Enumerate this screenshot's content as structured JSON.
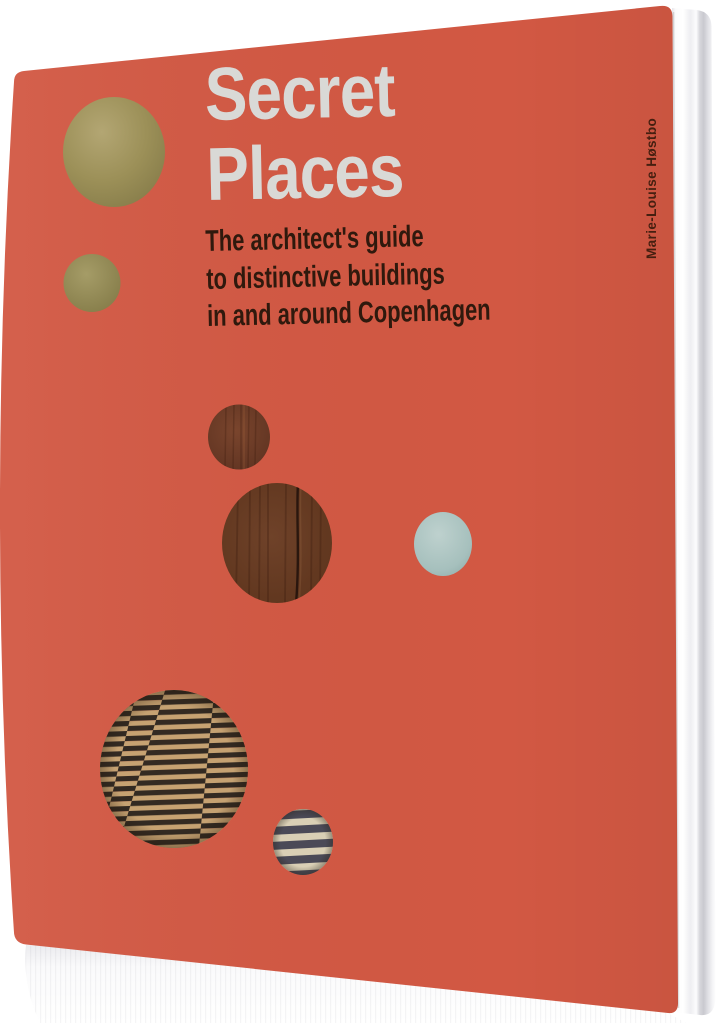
{
  "book": {
    "title": {
      "line1": "Secret",
      "line2": "Places",
      "color": "#d9d9d6"
    },
    "subtitle": {
      "line1": "The architect's guide",
      "line2": "to distinctive buildings",
      "line3": "in and around Copenhagen",
      "color": "#2f190d"
    },
    "author": {
      "name": "Marie-Louise Høstbo",
      "color": "#451f10"
    },
    "cover_color": "#d25843",
    "pages_color": "#f0f0f3",
    "decorative_circles": [
      {
        "name": "brass-circle-large",
        "color": "#9c9058"
      },
      {
        "name": "brass-circle-small",
        "color": "#948a55"
      },
      {
        "name": "wood-circle-small",
        "color": "#6e3b28"
      },
      {
        "name": "wood-circle-large",
        "color": "#5f3624"
      },
      {
        "name": "pale-blue-circle",
        "color": "#a6c0bd"
      },
      {
        "name": "striped-floor-circle-large",
        "colors": [
          "#332a22",
          "#c6a272"
        ]
      },
      {
        "name": "striped-circle-small",
        "colors": [
          "#4b4a57",
          "#d9cfb5"
        ]
      }
    ]
  }
}
